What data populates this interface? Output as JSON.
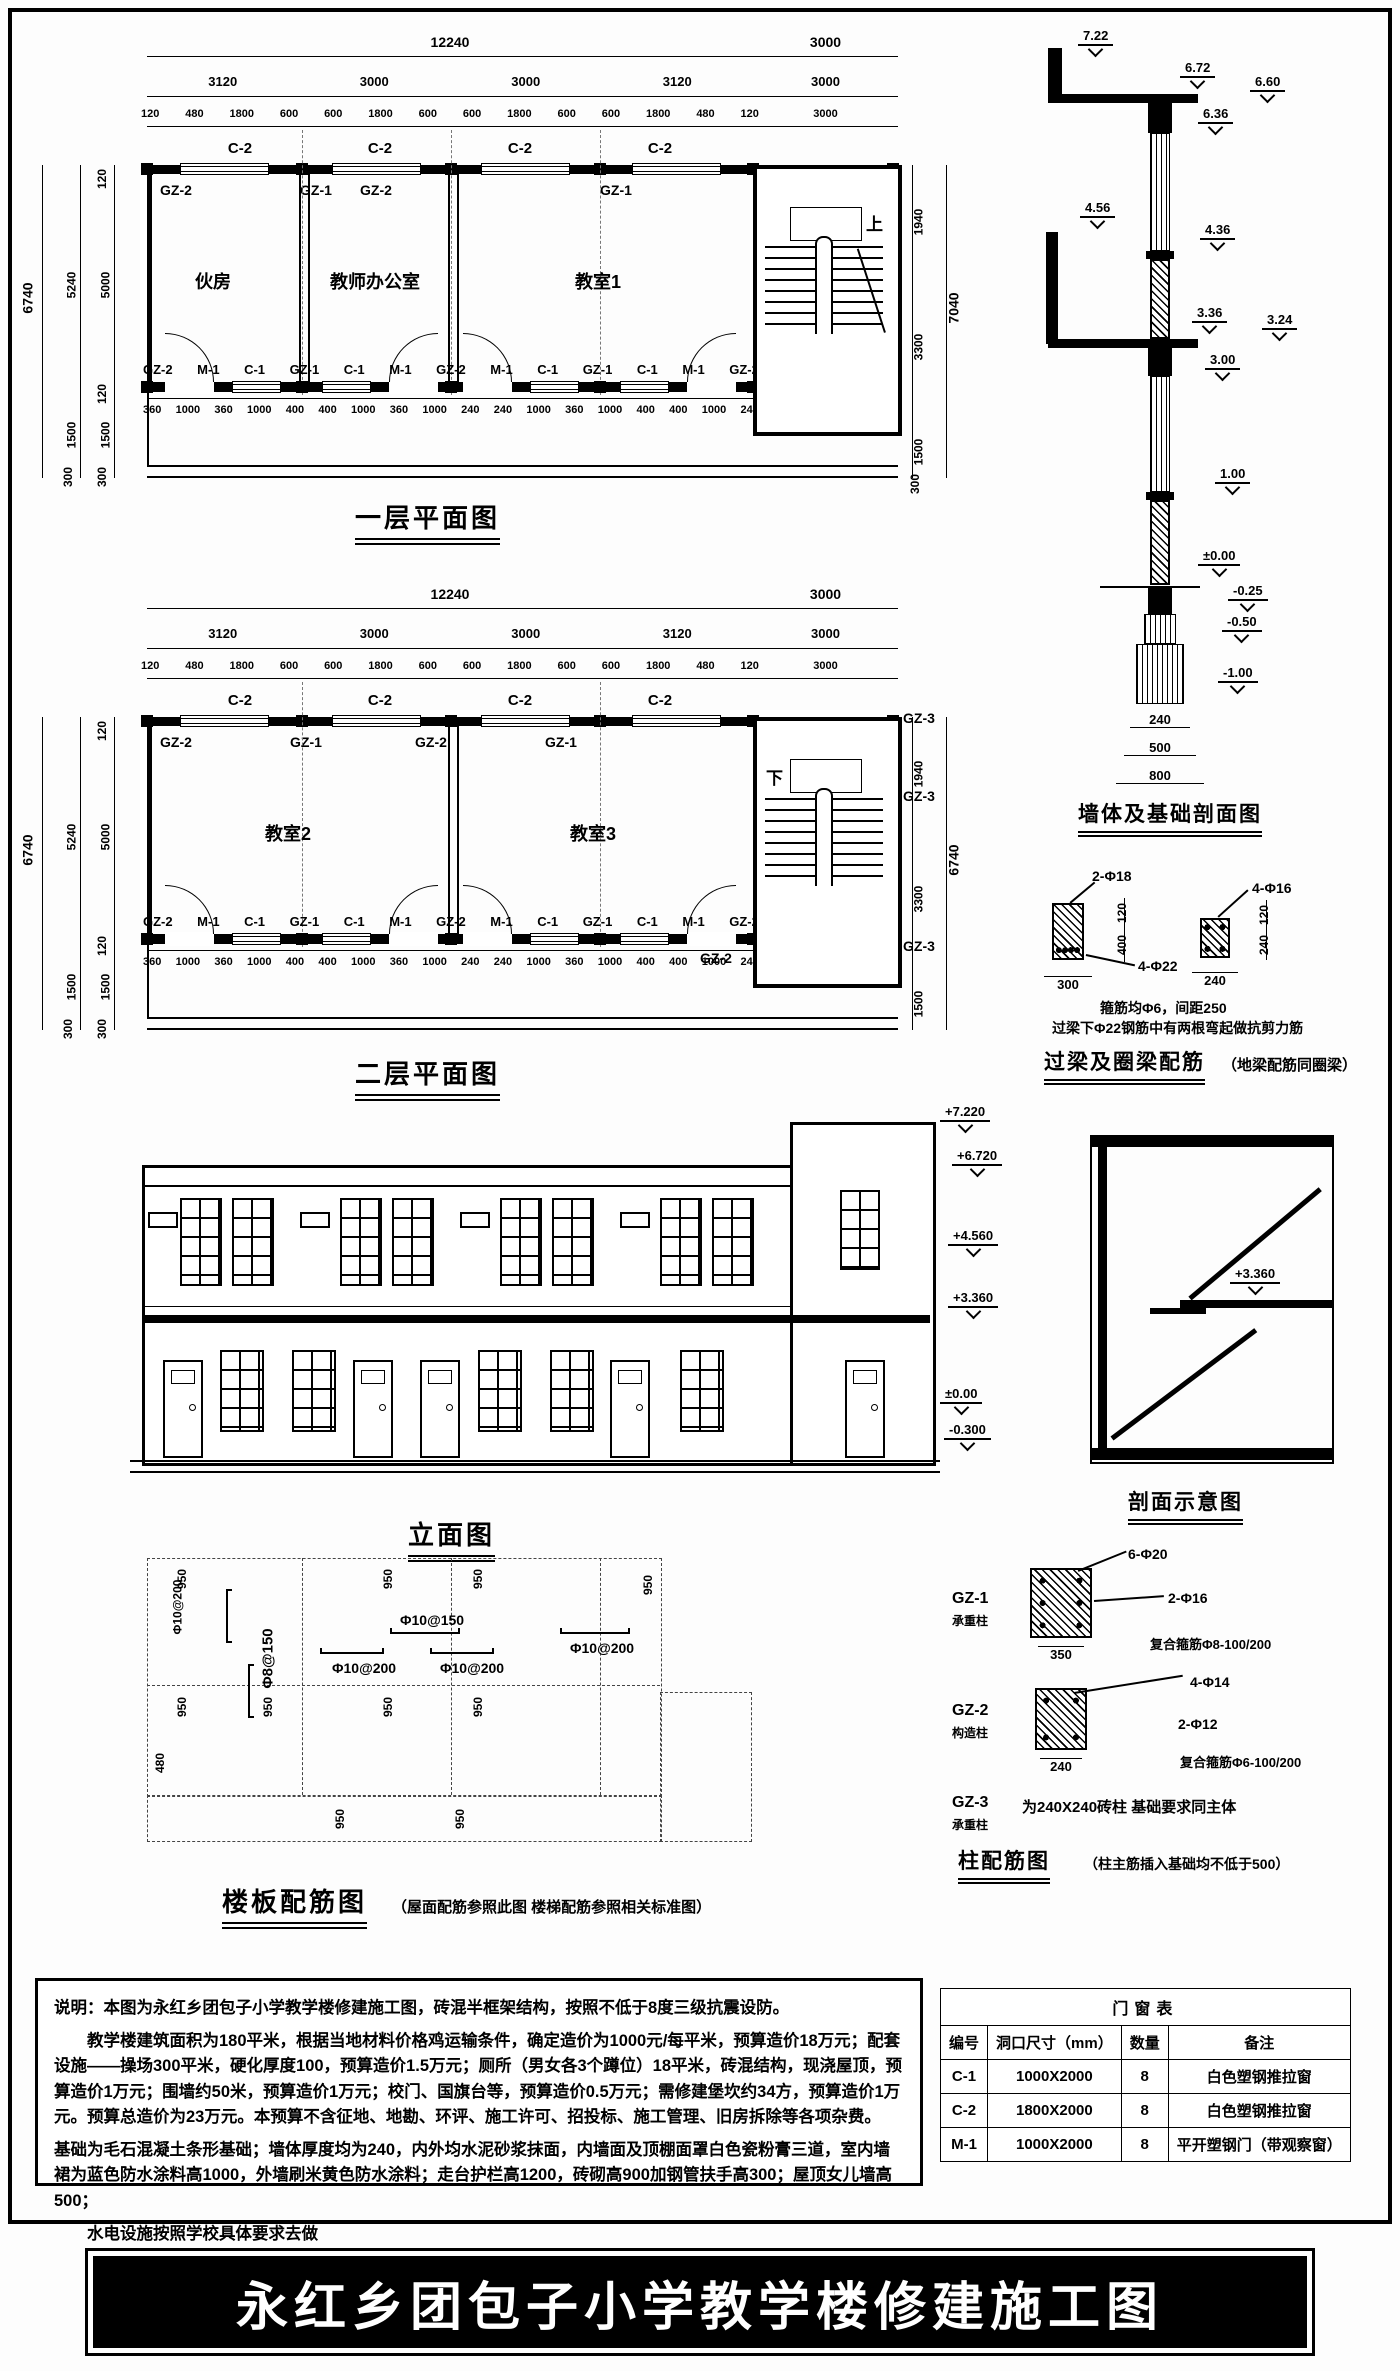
{
  "sheet": {
    "main_title": "永红乡团包子小学教学楼修建施工图"
  },
  "plan1": {
    "title": "一层平面图",
    "dims_total": "12240",
    "dims_stair": "3000",
    "bays": [
      "3120",
      "3000",
      "3000",
      "3120"
    ],
    "subdims": [
      "120",
      "480",
      "1800",
      "600",
      "600",
      "1800",
      "600",
      "600",
      "1800",
      "600",
      "600",
      "1800",
      "480",
      "120"
    ],
    "window_labels": [
      "C-2",
      "C-2",
      "C-2",
      "C-2"
    ],
    "col_labels": [
      "GZ-2",
      "GZ-1",
      "GZ-2",
      "GZ-1",
      "GZ-2"
    ],
    "rooms": [
      "伙房",
      "教师办公室",
      "教室1"
    ],
    "stair_dir": "上",
    "bottom_labels": [
      "GZ-2",
      "M-1",
      "C-1",
      "GZ-1",
      "C-1",
      "M-1",
      "GZ-2",
      "M-1",
      "C-1",
      "GZ-1",
      "C-1",
      "M-1",
      "GZ-2"
    ],
    "bottom_dims": [
      "360",
      "1000",
      "360",
      "1000",
      "400",
      "400",
      "1000",
      "360",
      "1000",
      "240",
      "240",
      "1000",
      "360",
      "1000",
      "400",
      "400",
      "1000",
      "240"
    ],
    "left_total": "6740",
    "left_outer": [
      "5240",
      "1500",
      "300"
    ],
    "left_inner": [
      "120",
      "5000",
      "120",
      "1500",
      "300"
    ],
    "right_dims": [
      "1940",
      "3300",
      "1500",
      "300"
    ],
    "right_total": "7040"
  },
  "plan2": {
    "title": "二层平面图",
    "dims_total": "12240",
    "dims_stair": "3000",
    "bays": [
      "3120",
      "3000",
      "3000",
      "3120"
    ],
    "subdims": [
      "120",
      "480",
      "1800",
      "600",
      "600",
      "1800",
      "600",
      "600",
      "1800",
      "600",
      "600",
      "1800",
      "480",
      "120"
    ],
    "window_labels": [
      "C-2",
      "C-2",
      "C-2",
      "C-2"
    ],
    "col_labels": [
      "GZ-2",
      "GZ-1",
      "GZ-2",
      "GZ-1"
    ],
    "gz3_labels": [
      "GZ-3",
      "GZ-3",
      "GZ-3"
    ],
    "stair_corner_label": "GZ-2",
    "rooms": [
      "教室2",
      "教室3"
    ],
    "stair_dir": "下",
    "bottom_labels": [
      "GZ-2",
      "M-1",
      "C-1",
      "GZ-1",
      "C-1",
      "M-1",
      "GZ-2",
      "M-1",
      "C-1",
      "GZ-1",
      "C-1",
      "M-1",
      "GZ-2"
    ],
    "bottom_dims": [
      "360",
      "1000",
      "360",
      "1000",
      "400",
      "400",
      "1000",
      "360",
      "1000",
      "240",
      "240",
      "1000",
      "360",
      "1000",
      "400",
      "400",
      "1000",
      "240"
    ],
    "left_total": "6740",
    "left_outer": [
      "5240",
      "1500",
      "300"
    ],
    "left_inner": [
      "120",
      "5000",
      "120",
      "1500",
      "300"
    ],
    "right_dims": [
      "1940",
      "3300",
      "1500"
    ],
    "right_total": "6740"
  },
  "wall_section": {
    "title": "墙体及基础剖面图",
    "marks": [
      "7.22",
      "6.72",
      "6.60",
      "6.36",
      "4.56",
      "4.36",
      "3.36",
      "3.24",
      "3.00",
      "1.00",
      "±0.00",
      "-0.25",
      "-0.50",
      "-1.00"
    ],
    "width_dims": [
      "240",
      "500",
      "800"
    ]
  },
  "lintel": {
    "title": "过梁及圈梁配筋",
    "subtitle": "（地梁配筋同圈梁）",
    "left_top_bars": "2-Φ18",
    "left_bottom_bars": "4-Φ22",
    "left_h1": "120",
    "left_h2": "400",
    "left_w": "300",
    "right_top_bars": "4-Φ16",
    "right_h1": "120",
    "right_h2": "240",
    "right_w": "240",
    "note1": "箍筋均Φ6，间距250",
    "note2": "过梁下Φ22钢筋中有两根弯起做抗剪力筋"
  },
  "elevation": {
    "title": "立面图",
    "marks": [
      "+7.220",
      "+6.720",
      "+4.560",
      "+3.360",
      "±0.00",
      "-0.300"
    ]
  },
  "section": {
    "title": "剖面示意图",
    "mark": "+3.360"
  },
  "slab": {
    "title": "楼板配筋图",
    "subtitle": "（屋面配筋参照此图  楼梯配筋参照相关标准图）",
    "rebar_labels": [
      "Φ10@200",
      "Φ10@150",
      "Φ8@150",
      "Φ10@200",
      "Φ10@200",
      "Φ10@200"
    ],
    "ticks_950": [
      "950",
      "950",
      "950",
      "950",
      "950",
      "950",
      "950",
      "950",
      "950",
      "950"
    ],
    "tick_480": "480"
  },
  "columns": {
    "title": "柱配筋图",
    "subtitle": "（柱主筋插入基础均不低于500）",
    "items": [
      {
        "name": "GZ-1",
        "type": "承重柱",
        "bars": "6-Φ20",
        "side": "2-Φ16",
        "hoop": "复合箍筋Φ8-100/200",
        "w": "350"
      },
      {
        "name": "GZ-2",
        "type": "构造柱",
        "bars": "4-Φ14",
        "side": "2-Φ12",
        "hoop": "复合箍筋Φ6-100/200",
        "w": "240"
      },
      {
        "name": "GZ-3",
        "type": "承重柱",
        "note": "为240X240砖柱 基础要求同主体"
      }
    ]
  },
  "notes": {
    "line1": "说明：本图为永红乡团包子小学教学楼修建施工图，砖混半框架结构，按照不低于8度三级抗震设防。",
    "para1": "教学楼建筑面积为180平米，根据当地材料价格鸡运输条件，确定造价为1000元/每平米，预算造价18万元；配套设施——操场300平米，硬化厚度100，预算造价1.5万元；厕所（男女各3个蹲位）18平米，砖混结构，现浇屋顶，预算造价1万元；围墙约50米，预算造价1万元；校门、国旗台等，预算造价0.5万元；需修建堡坎约34方，预算造价1万元。预算总造价为23万元。本预算不含征地、地勘、环评、施工许可、招投标、施工管理、旧房拆除等各项杂费。",
    "para2": "基础为毛石混凝土条形基础；墙体厚度均为240，内外均水泥砂浆抹面，内墙面及顶棚面罩白色瓷粉膏三道，室内墙裙为蓝色防水涂料高1000，外墙刷米黄色防水涂料；走台护栏高1200，砖砌高900加钢管扶手高300；屋顶女儿墙高500；",
    "para3": "水电设施按照学校具体要求去做"
  },
  "door_table": {
    "title": "门窗表",
    "headers": [
      "编号",
      "洞口尺寸（mm）",
      "数量",
      "备注"
    ],
    "rows": [
      [
        "C-1",
        "1000X2000",
        "8",
        "白色塑钢推拉窗"
      ],
      [
        "C-2",
        "1800X2000",
        "8",
        "白色塑钢推拉窗"
      ],
      [
        "M-1",
        "1000X2000",
        "8",
        "平开塑钢门（带观察窗）"
      ]
    ]
  }
}
